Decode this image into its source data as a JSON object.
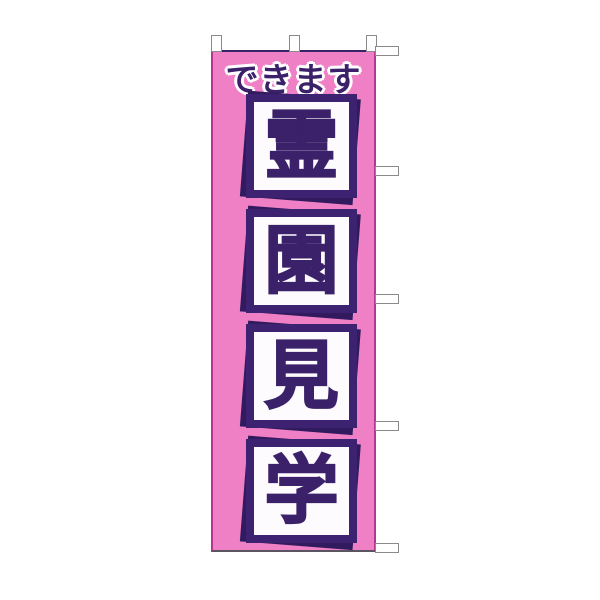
{
  "banner": {
    "header_text": "できます",
    "phrase": "霊園見学",
    "characters": [
      "霊",
      "園",
      "見",
      "学"
    ],
    "tabs": {
      "top_count": 3,
      "right_count": 5
    },
    "colors": {
      "banner_pink": "#ef80c5",
      "text_purple": "#3b2169",
      "box_border_purple": "#3e2272",
      "box_shadow_purple": "#311b5e",
      "edge_magenta": "#b5368f",
      "top_edge_purple": "#3a2268",
      "bottom_edge_gray": "#5a5560",
      "tab_white": "#ffffff",
      "tab_border_gray": "#8a8a8a"
    }
  }
}
